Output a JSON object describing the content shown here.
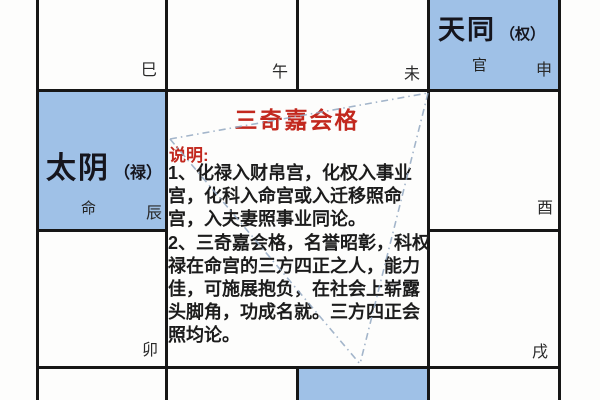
{
  "colors": {
    "highlight_blue": "#9fc1e7",
    "grid_black": "#161616",
    "accent_red": "#c2281e",
    "body_text": "#1c1c1c",
    "dash_line_blue": "#94a9c2"
  },
  "palaces": {
    "si": {
      "branch": "巳"
    },
    "wu": {
      "branch": "午"
    },
    "wei": {
      "branch": "未"
    },
    "shen": {
      "star": "天同",
      "hua": "（权）",
      "palace": "官",
      "branch": "申"
    },
    "chen": {
      "star": "太阴",
      "hua": "（禄）",
      "palace": "命",
      "branch": "辰"
    },
    "you": {
      "branch": "酉"
    },
    "mao": {
      "branch": "卯"
    },
    "xu": {
      "branch": "戌"
    }
  },
  "center": {
    "title": "三奇嘉会格",
    "label": "说明:",
    "lines": [
      "1、化禄入财帛宫，化权入事业",
      "宫，化科入命宫或入迁移照命",
      "宫，入夫妻照事业同论。",
      "2、三奇嘉会格，名誉昭彰，科权",
      "禄在命宫的三方四正之人，能力",
      "佳，可施展抱负，在社会上崭露",
      "头脚角，功成名就。三方四正会",
      "照均论。"
    ]
  }
}
